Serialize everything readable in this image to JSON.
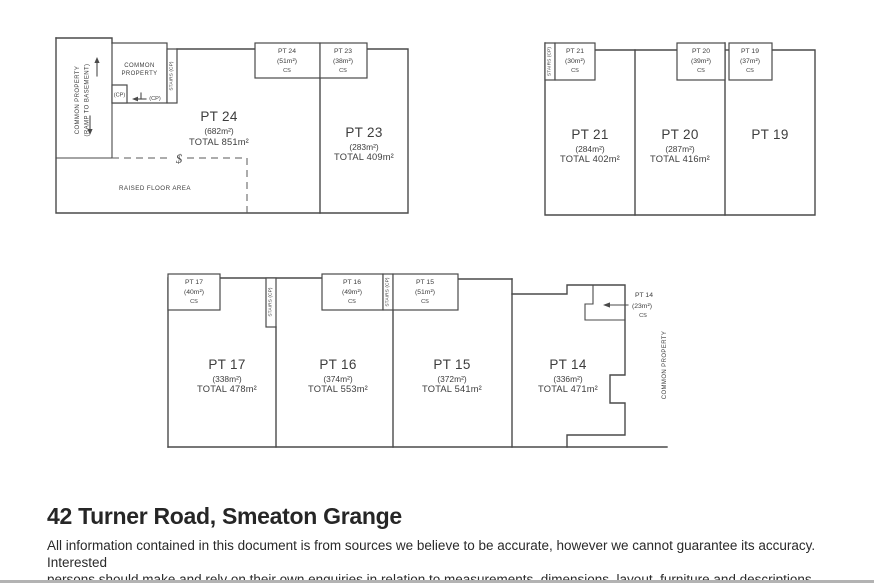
{
  "page": {
    "title": "42 Turner Road, Smeaton Grange",
    "disclaimer_line1": "All information contained in this document is from sources we believe to be accurate, however we cannot guarantee its accuracy. Interested",
    "disclaimer_line2": "persons should make and rely on their own enquiries in relation to measurements, dimensions, layout, furniture and descriptions."
  },
  "labels": {
    "common_property": "COMMON PROPERTY",
    "common_property_l1": "COMMON",
    "common_property_l2": "PROPERTY",
    "ramp_to_basement": "(RAMP TO BASEMENT)",
    "stairs_cp": "STAIRS (CP)",
    "cp": "(CP)",
    "raised_floor_area": "RAISED FLOOR AREA",
    "cs": "CS",
    "section_marker": "$"
  },
  "units": {
    "pt24": {
      "name": "PT 24",
      "area": "(682m²)",
      "total": "TOTAL 851m²",
      "cs_area": "(51m²)"
    },
    "pt23": {
      "name": "PT 23",
      "area": "(283m²)",
      "total": "TOTAL 409m²",
      "cs_area": "(38m²)"
    },
    "pt21": {
      "name": "PT 21",
      "area": "(284m²)",
      "total": "TOTAL 402m²",
      "cs_area": "(30m²)"
    },
    "pt20": {
      "name": "PT 20",
      "area": "(287m²)",
      "total": "TOTAL 416m²",
      "cs_area": "(39m²)"
    },
    "pt19": {
      "name": "PT 19",
      "cs_area": "(37m²)"
    },
    "pt17": {
      "name": "PT 17",
      "area": "(338m²)",
      "total": "TOTAL 478m²",
      "cs_area": "(40m²)"
    },
    "pt16": {
      "name": "PT 16",
      "area": "(374m²)",
      "total": "TOTAL 553m²",
      "cs_area": "(49m²)"
    },
    "pt15": {
      "name": "PT 15",
      "area": "(372m²)",
      "total": "TOTAL 541m²",
      "cs_area": "(51m²)"
    },
    "pt14": {
      "name": "PT 14",
      "area": "(336m²)",
      "total": "TOTAL 471m²",
      "cs_area": "(23m²)"
    }
  },
  "colors": {
    "line": "#4a4a4a",
    "text": "#3d3d3d"
  }
}
